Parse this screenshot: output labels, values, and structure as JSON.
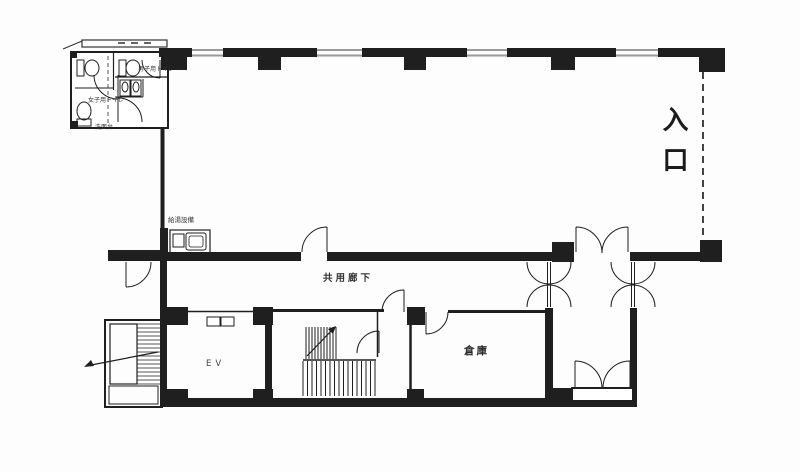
{
  "labels": {
    "entrance": "入口",
    "corridor": "共用廊下",
    "elevator": "EV",
    "warehouse": "倉庫",
    "kitchenette": "給湯設備",
    "mens_toilet": "男子用トイレ",
    "womens_toilet": "女子用トイレ",
    "washstand": "洗面台"
  },
  "colors": {
    "background": "#fdfdfd",
    "wall_line": "#1f1f1f",
    "window_gray": "#9a9a9a",
    "text": "#2a2a2a"
  }
}
